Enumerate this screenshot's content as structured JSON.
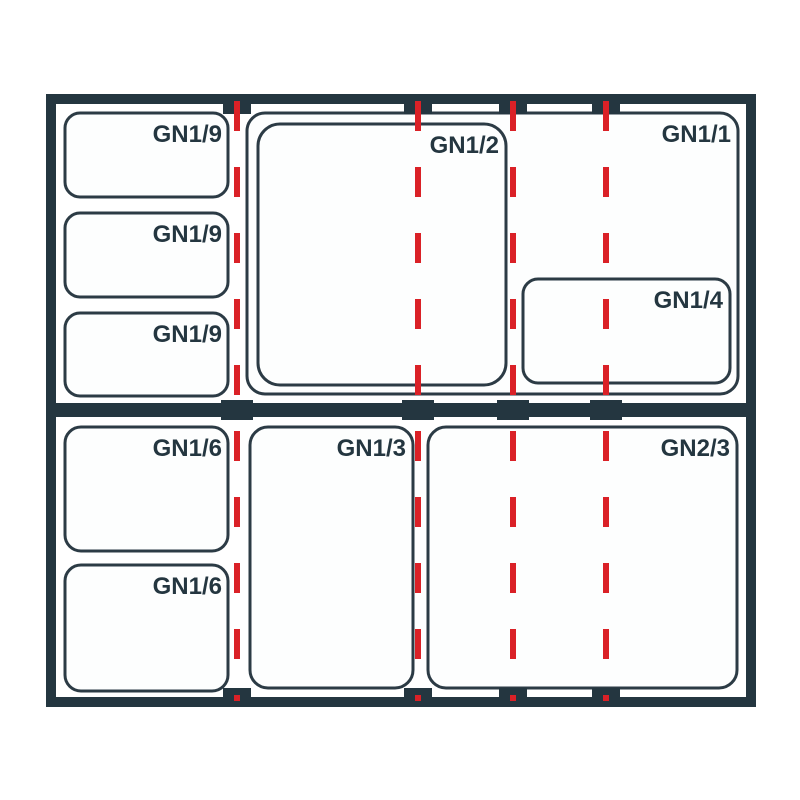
{
  "colors": {
    "frame": "#243640",
    "outline": "#2c3b45",
    "label": "#243640",
    "divider": "#da2127",
    "box_fill": "#fdfefe",
    "background": "#ffffff"
  },
  "top_frame": {
    "containers": [
      {
        "label": "GN1/9"
      },
      {
        "label": "GN1/9"
      },
      {
        "label": "GN1/9"
      },
      {
        "label": "GN1/1"
      },
      {
        "label": "GN1/2"
      },
      {
        "label": "GN1/4"
      }
    ]
  },
  "bottom_frame": {
    "containers": [
      {
        "label": "GN1/6"
      },
      {
        "label": "GN1/6"
      },
      {
        "label": "GN1/3"
      },
      {
        "label": "GN2/3"
      }
    ]
  }
}
